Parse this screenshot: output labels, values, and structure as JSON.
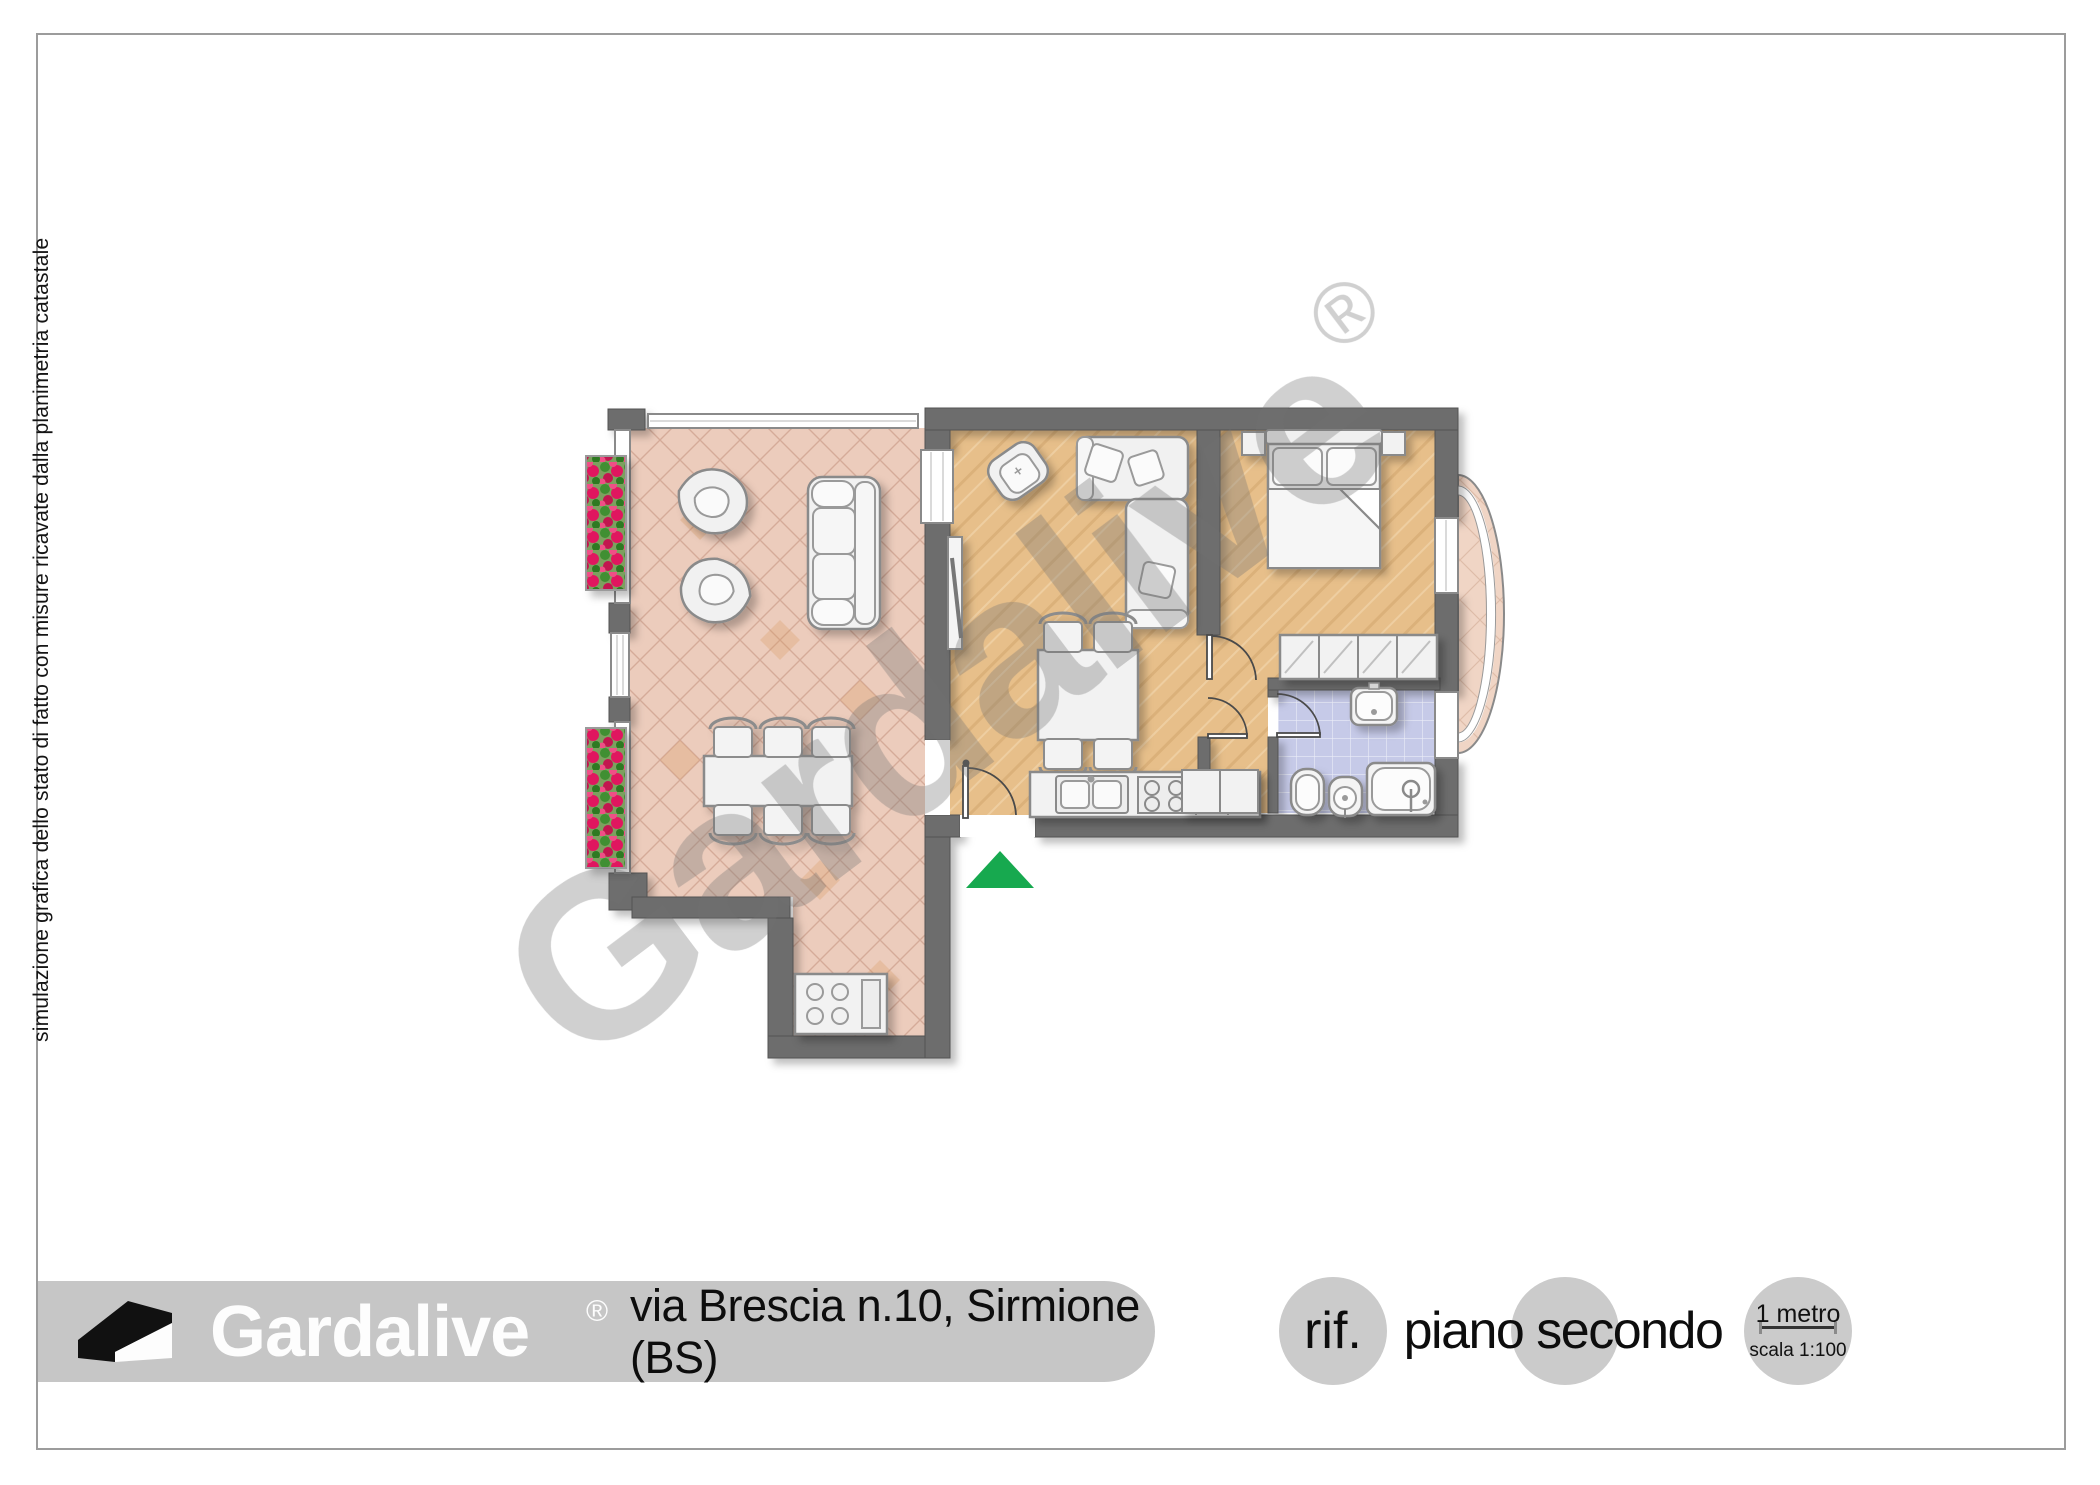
{
  "page": {
    "side_note": "simulazione grafica dello stato di fatto con misure ricavate dalla planimetria catastale"
  },
  "watermark": {
    "text": "Gardalive",
    "reg": "®"
  },
  "footer": {
    "brand": "Gardalive",
    "brand_reg": "®",
    "address": "via Brescia n.10, Sirmione (BS)",
    "ref_label": "rif.",
    "floor_label": "piano secondo",
    "scale_length_label": "1 metro",
    "scale_ratio_label": "scala 1:100"
  },
  "colors": {
    "wall": "#6d6d6d",
    "terrace_floor": "#ecccbc",
    "wood_floor": "#e7bf8a",
    "bathroom_floor": "#c6cae8",
    "bow_window_floor": "#f0d5c5",
    "footer_bar": "#c6c6c6",
    "footer_circle": "#cbcbcb",
    "entrance_arrow": "#17a94f",
    "flowers": "#e0195f",
    "leaves": "#3f8f30",
    "watermark_gray": "#707070"
  }
}
